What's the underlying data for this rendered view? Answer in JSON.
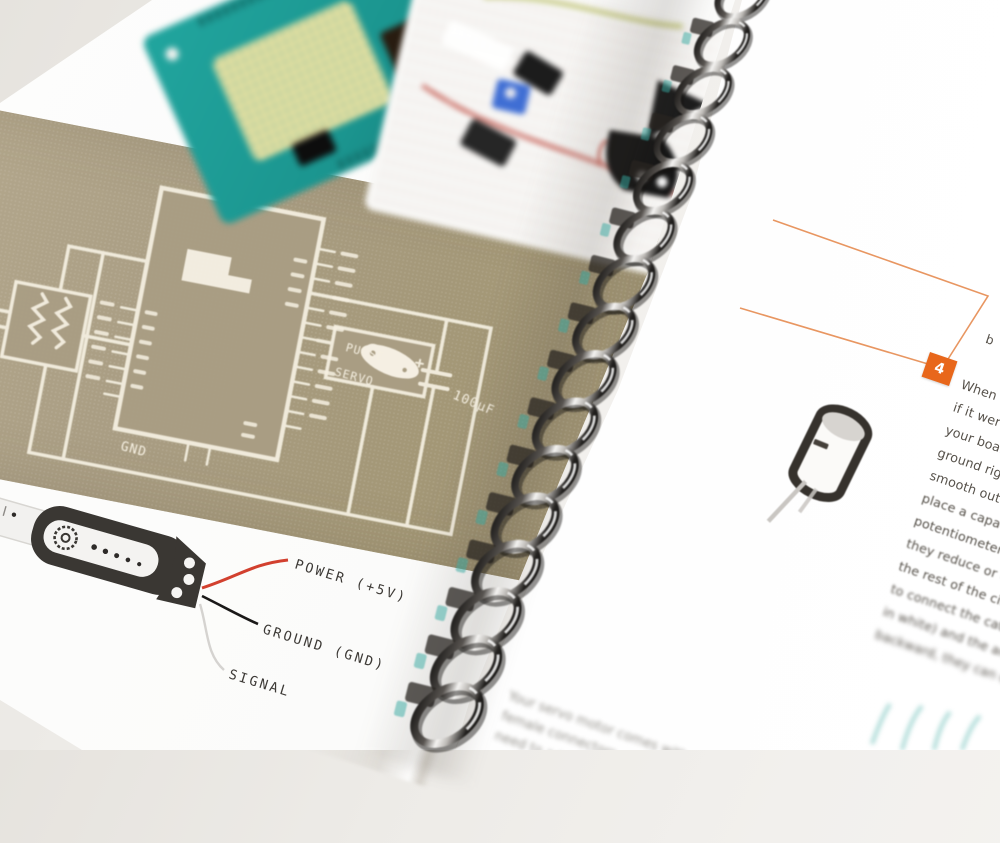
{
  "book": {
    "left_page": {
      "schematic": {
        "gnd_label": "GND",
        "pulse_label": "PULSE",
        "servo_label": "SERVO",
        "capacitor_value": "100µF"
      },
      "servo_pinout": {
        "power_label": "POWER (+5V)",
        "ground_label": "GROUND (GND)",
        "signal_label": "SIGNAL",
        "power_wire_color": "#d2402e",
        "ground_wire_color": "#1b1918",
        "signal_wire_color": "#d0cecb"
      }
    },
    "right_page": {
      "step_badge": "4",
      "top_fragment": "b",
      "paragraph_lines": [
        "When the motor starts to move, it draws more current than",
        "if it were already in motion. This will cause a dip in the voltage on",
        "your board. By placing a 100µF capacitor across power and",
        "ground right next to the male headers as shown in the circuit, you can",
        "smooth out any voltage changes that may occur. You can also",
        "place a capacitor across the power and ground going into your",
        "potentiometer. These are called decoupling capacitors because",
        "they reduce or decouple changes caused by the components from",
        "the rest of the circuit. Be very careful to make sure you are",
        "to connect the cathode to ground (that's the side with a stripe,",
        "in white) and the anode to power. If you put the capacitors in",
        "backward, they can explode."
      ],
      "caption_lines": [
        "Your servo motor comes with",
        "female connectors, so you'll",
        "need to add header pins to"
      ]
    },
    "colors": {
      "accent_orange": "#e8671b",
      "panel_tan": "#a99d83",
      "arduino_teal": "#1ca09a"
    }
  }
}
